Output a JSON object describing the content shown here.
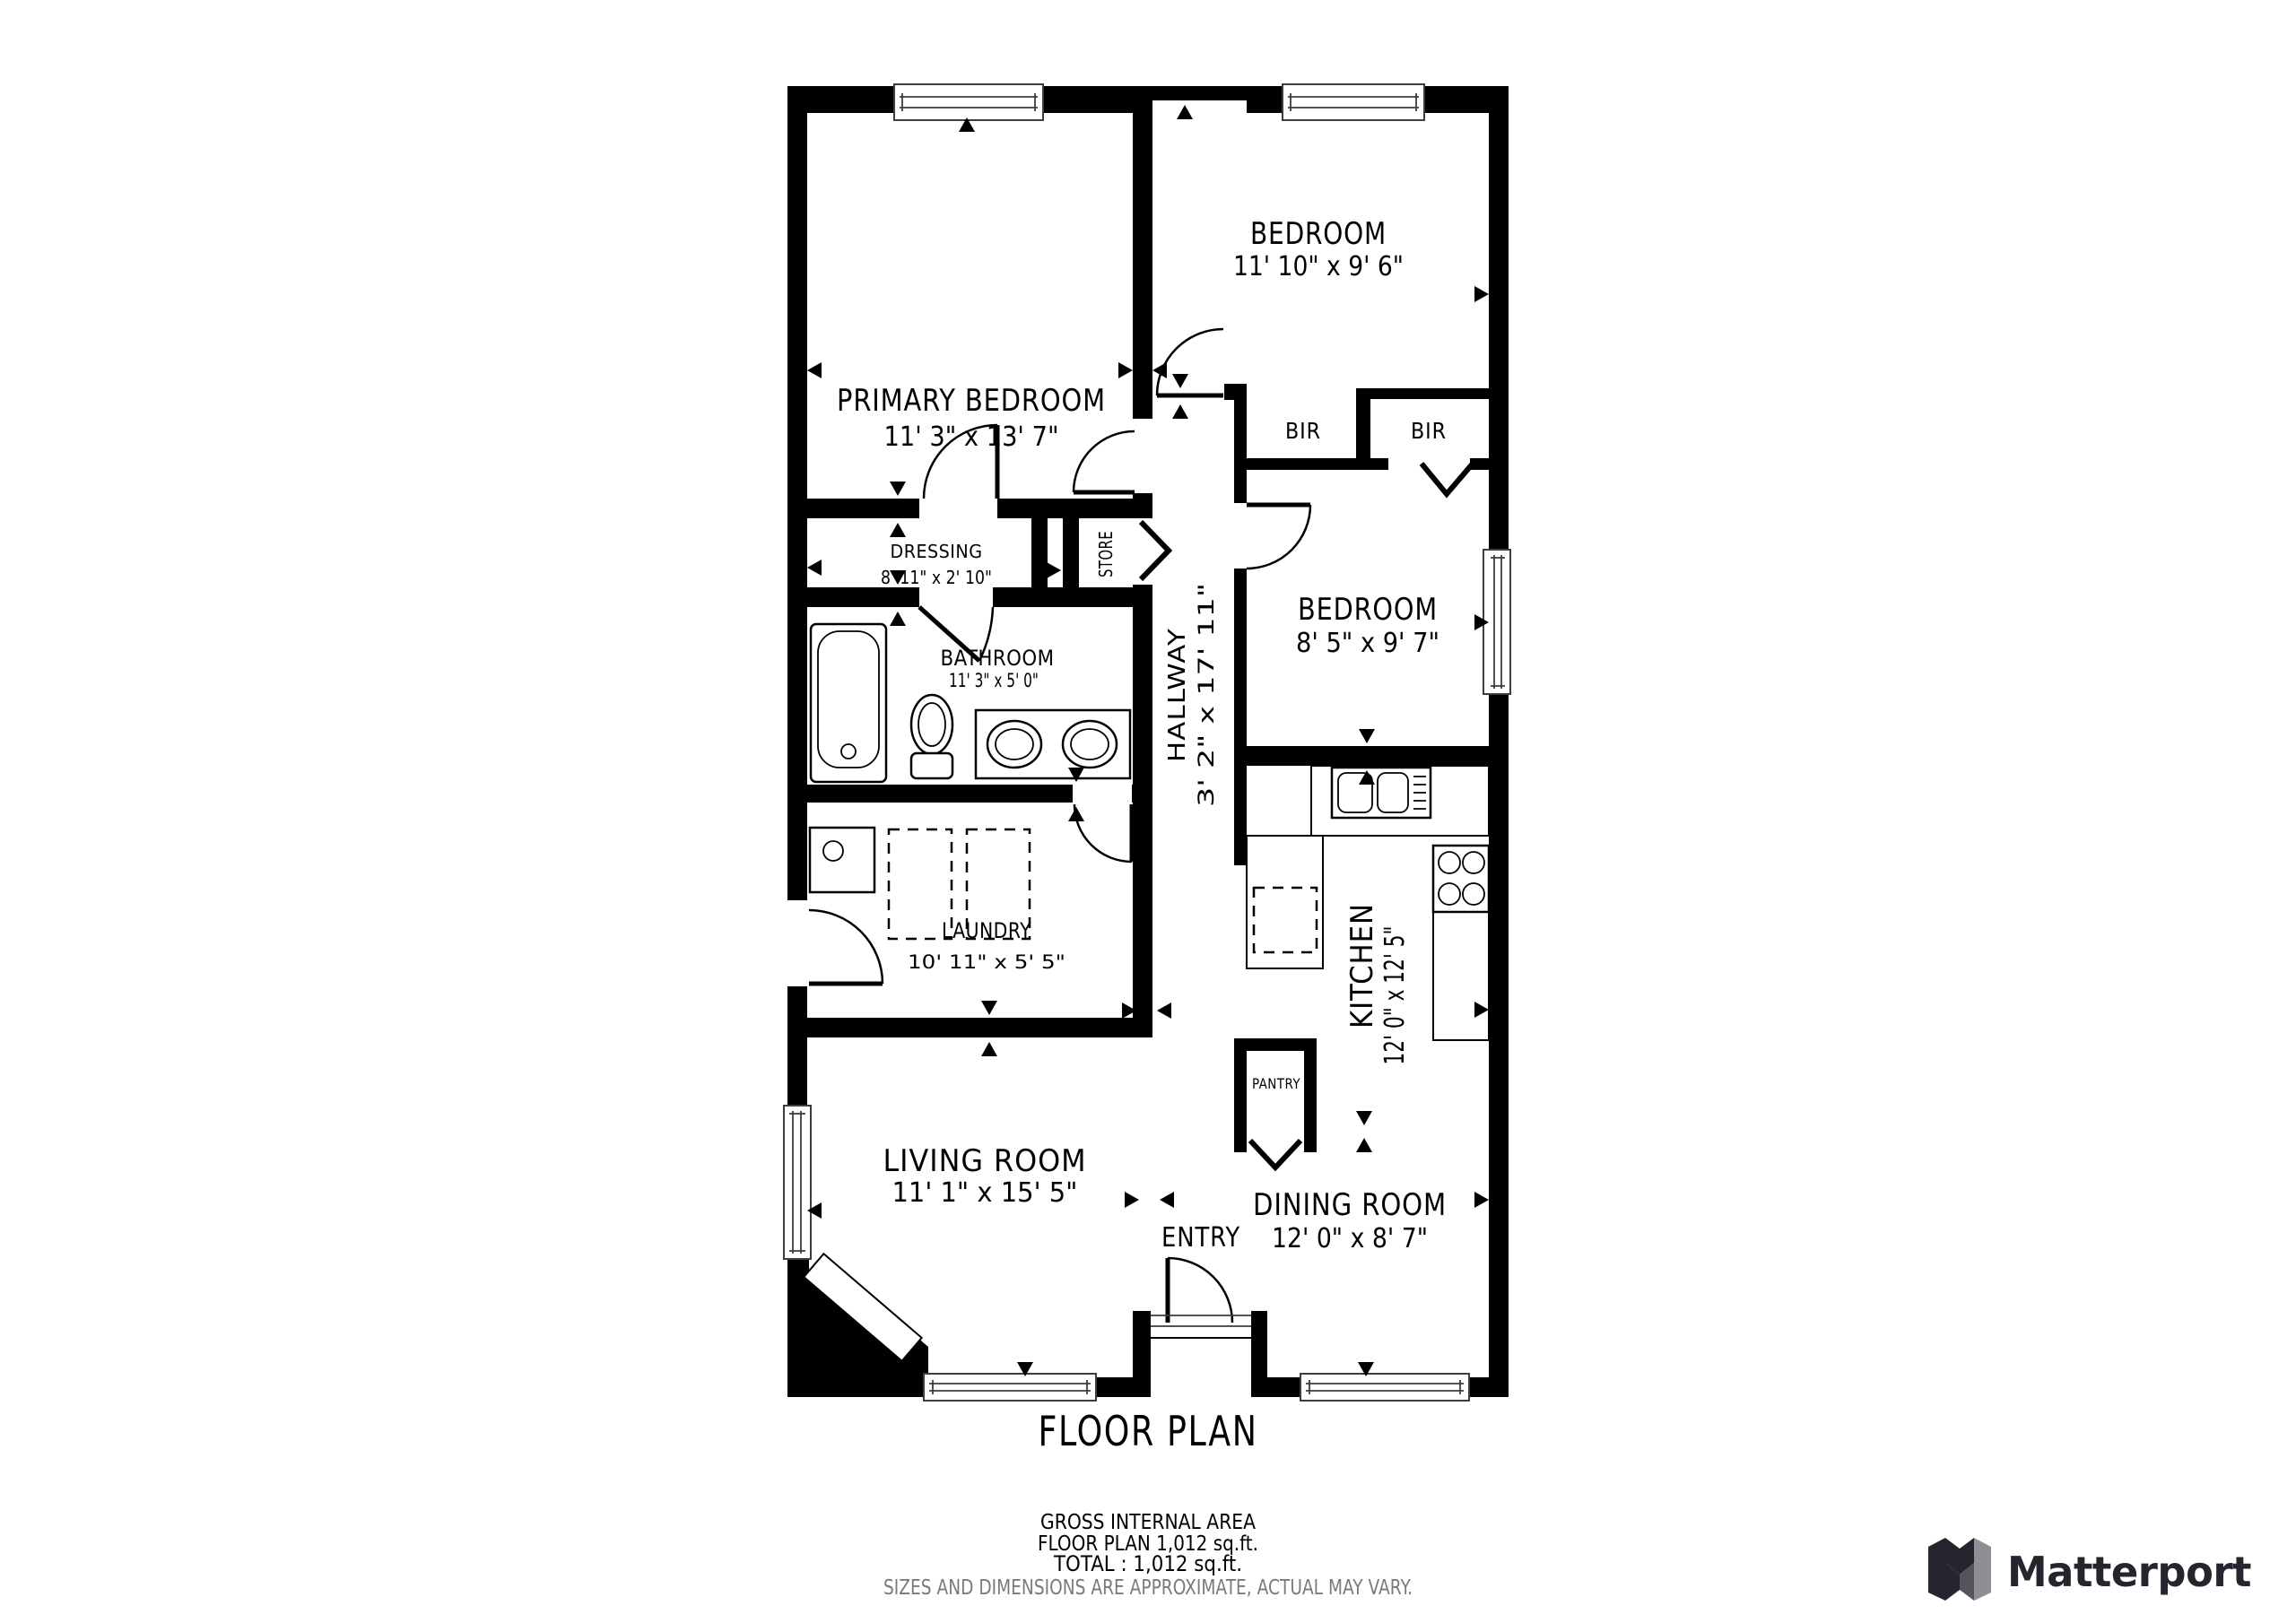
{
  "plan": {
    "rooms": [
      {
        "id": "primary-bedroom",
        "label": "PRIMARY BEDROOM",
        "dims": "11' 3\" x 13' 7\""
      },
      {
        "id": "bedroom-top",
        "label": "BEDROOM",
        "dims": "11' 10\" x 9' 6\""
      },
      {
        "id": "bir-left",
        "label": "BIR"
      },
      {
        "id": "bir-right",
        "label": "BIR"
      },
      {
        "id": "bedroom-mid",
        "label": "BEDROOM",
        "dims": "8' 5\" x 9' 7\""
      },
      {
        "id": "dressing",
        "label": "DRESSING",
        "dims": "8' 11\" x 2' 10\""
      },
      {
        "id": "store",
        "label": "STORE"
      },
      {
        "id": "bathroom",
        "label": "BATHROOM",
        "dims": "11' 3\" x 5' 0\""
      },
      {
        "id": "hallway",
        "label": "HALLWAY",
        "dims": "3' 2\" x 17' 11\""
      },
      {
        "id": "laundry",
        "label": "LAUNDRY",
        "dims": "10' 11\" x 5' 5\""
      },
      {
        "id": "kitchen",
        "label": "KITCHEN",
        "dims": "12' 0\" x 12' 5\""
      },
      {
        "id": "pantry",
        "label": "PANTRY"
      },
      {
        "id": "living-room",
        "label": "LIVING ROOM",
        "dims": "11' 1\" x 15' 5\""
      },
      {
        "id": "dining-room",
        "label": "DINING ROOM",
        "dims": "12' 0\" x 8' 7\""
      },
      {
        "id": "entry",
        "label": "ENTRY"
      }
    ]
  },
  "footer": {
    "title": "FLOOR PLAN",
    "line1": "GROSS INTERNAL AREA",
    "line2": "FLOOR PLAN 1,012 sq.ft.",
    "line3": "TOTAL :  1,012 sq.ft.",
    "disclaimer": "SIZES AND DIMENSIONS ARE APPROXIMATE, ACTUAL MAY VARY."
  },
  "branding": {
    "wordmark": "Matterport"
  },
  "colors": {
    "ink": "#000000",
    "muted": "#7a7a7a",
    "logo_dark": "#26252e",
    "logo_gray": "#8e8e93"
  }
}
